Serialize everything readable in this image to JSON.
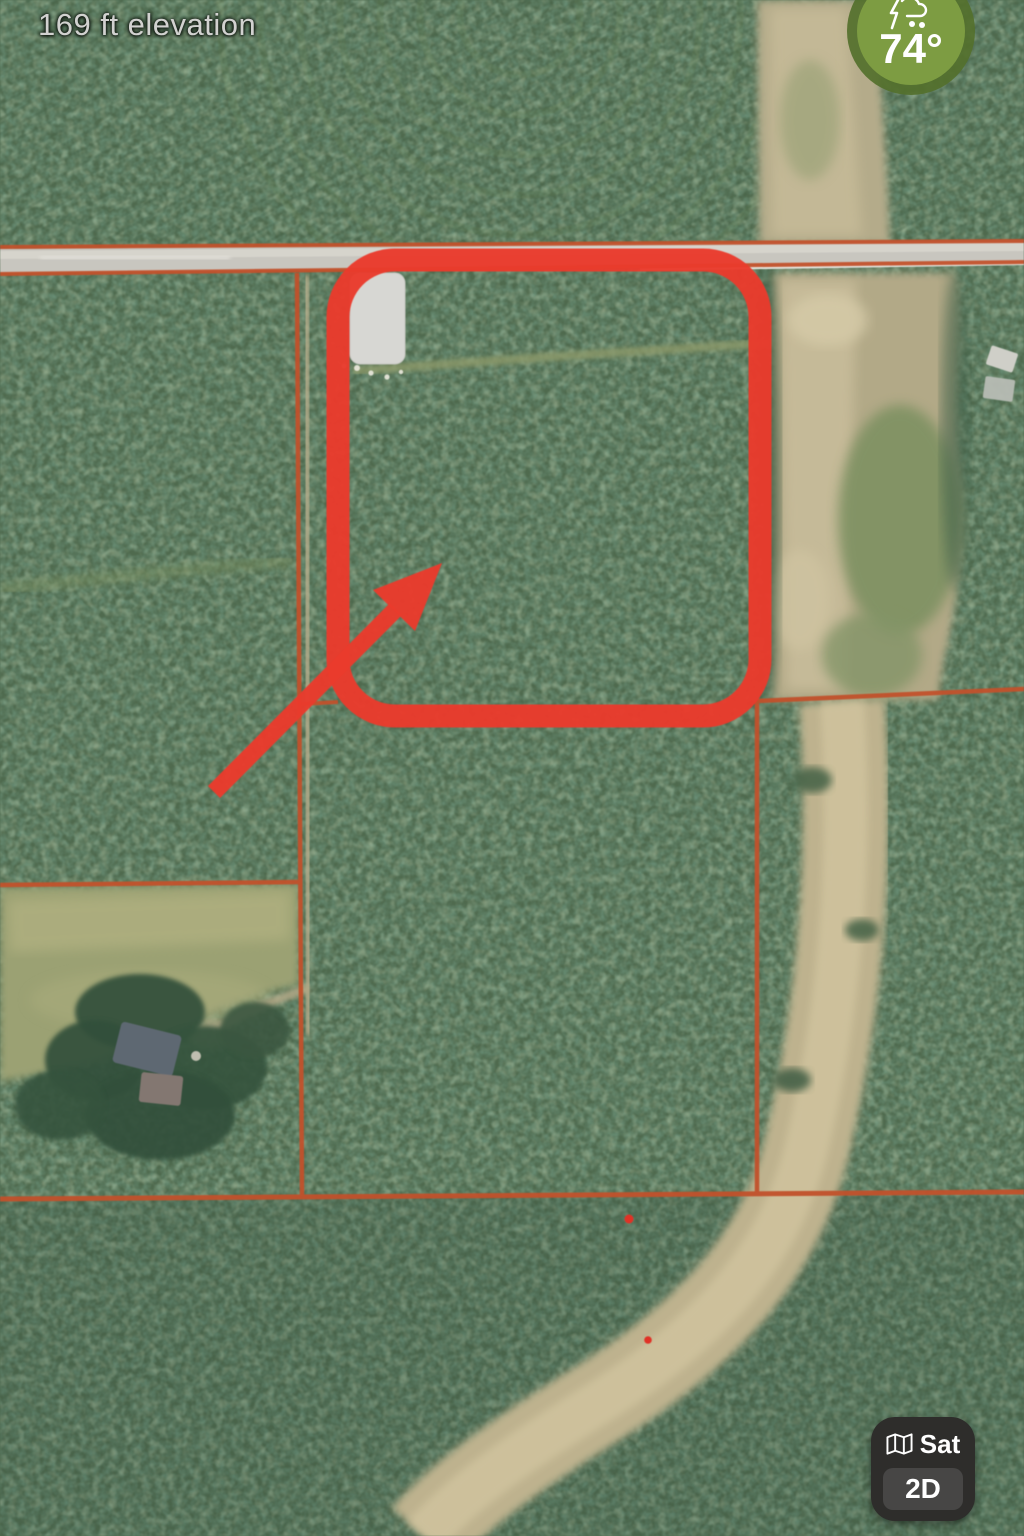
{
  "map_overlay": {
    "elevation_label": "169 ft elevation"
  },
  "weather_badge": {
    "temperature": "74°",
    "icon": "storm-rain-icon",
    "circle_color": "#7d9c42",
    "ring_color": "#54702c"
  },
  "map_controls": {
    "layer_label": "Sat",
    "layer_icon": "folded-map-icon",
    "view_mode_label": "2D"
  },
  "map_annotations": {
    "highlight_color": "#e93b2c",
    "parcel_line_color": "#c2512b",
    "marker_dot_color": "#e03226",
    "building_fill": "#d7d7d3"
  }
}
